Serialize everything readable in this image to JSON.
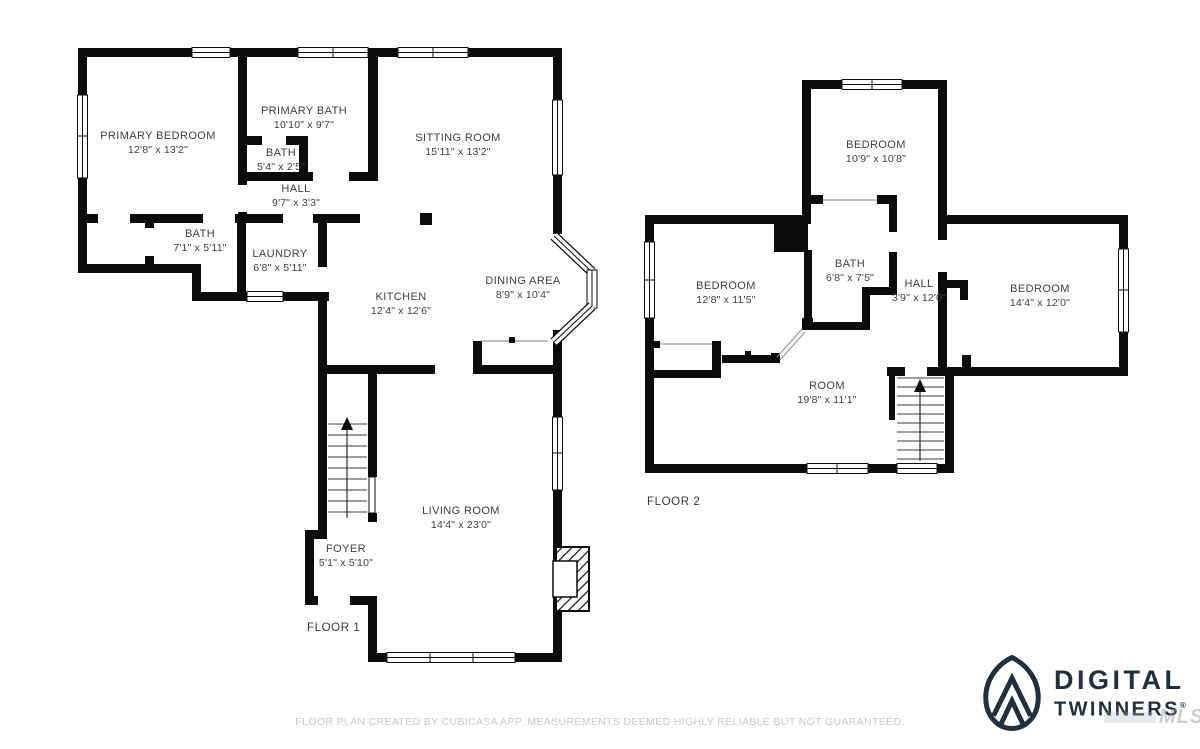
{
  "floors": [
    {
      "name": "FLOOR 1",
      "rooms": [
        {
          "label": "PRIMARY BEDROOM",
          "dims": "12'8\" x 13'2\""
        },
        {
          "label": "PRIMARY BATH",
          "dims": "10'10\" x 9'7\""
        },
        {
          "label": "BATH",
          "dims": "5'4\" x 2'5\""
        },
        {
          "label": "HALL",
          "dims": "9'7\" x 3'3\""
        },
        {
          "label": "SITTING ROOM",
          "dims": "15'11\" x 13'2\""
        },
        {
          "label": "BATH",
          "dims": "7'1\" x 5'11\""
        },
        {
          "label": "LAUNDRY",
          "dims": "6'8\" x 5'11\""
        },
        {
          "label": "KITCHEN",
          "dims": "12'4\" x 12'6\""
        },
        {
          "label": "DINING AREA",
          "dims": "8'9\" x 10'4\""
        },
        {
          "label": "LIVING ROOM",
          "dims": "14'4\" x 23'0\""
        },
        {
          "label": "FOYER",
          "dims": "5'1\" x 5'10\""
        }
      ]
    },
    {
      "name": "FLOOR 2",
      "rooms": [
        {
          "label": "BEDROOM",
          "dims": "10'9\" x 10'8\""
        },
        {
          "label": "BEDROOM",
          "dims": "12'8\" x 11'5\""
        },
        {
          "label": "BATH",
          "dims": "6'8\" x 7'5\""
        },
        {
          "label": "HALL",
          "dims": "3'9\" x 12'0\""
        },
        {
          "label": "BEDROOM",
          "dims": "14'4\" x 12'0\""
        },
        {
          "label": "ROOM",
          "dims": "19'8\" x 11'1\""
        }
      ]
    }
  ],
  "footer": {
    "disclaimer": "FLOOR PLAN CREATED BY CUBICASA APP. MEASUREMENTS DEEMED HIGHLY RELIABLE BUT NOT GUARANTEED."
  },
  "branding": {
    "name_line1": "DIGITAL",
    "name_line2": "TWINNERS",
    "registered": "®",
    "watermark": "MLS"
  },
  "colors": {
    "wall": "#0b0b0b",
    "label_text": "#3f3f3f",
    "brand_navy": "#20303f",
    "disclaimer_gray": "#c9c9c9"
  }
}
